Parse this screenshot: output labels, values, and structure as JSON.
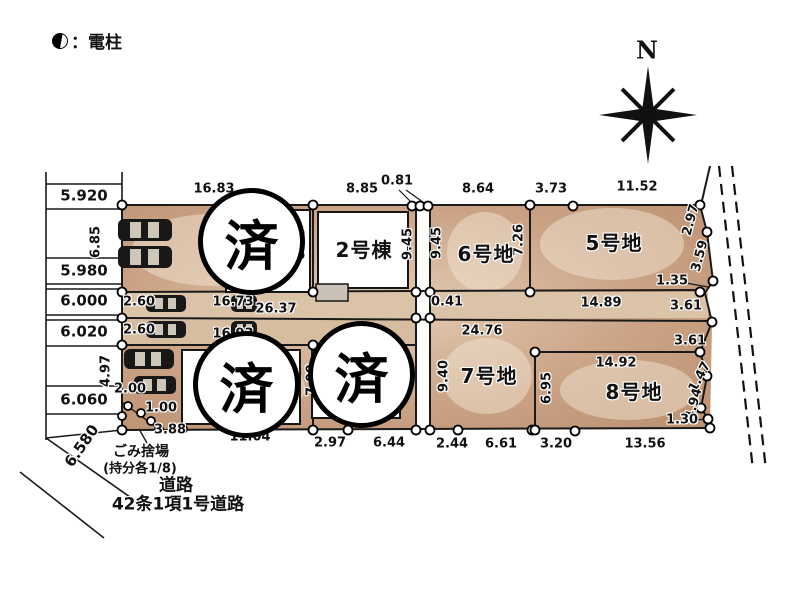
{
  "legend": {
    "label": "：電柱"
  },
  "compass": {
    "label": "N"
  },
  "sold_mark": "済",
  "colors": {
    "lot_fill": "#cba285",
    "lot_highlight": "#f1e5d3",
    "driveway": "#dbc3a8",
    "line": "#1a1a1a",
    "marker_fill": "#ffffff",
    "sold_border": "#000000"
  },
  "labels": [
    {
      "t": "16.83",
      "x": 214,
      "y": 189
    },
    {
      "t": "8.85",
      "x": 362,
      "y": 189
    },
    {
      "t": "0.81",
      "x": 397,
      "y": 181
    },
    {
      "t": "8.64",
      "x": 478,
      "y": 189
    },
    {
      "t": "3.73",
      "x": 551,
      "y": 189
    },
    {
      "t": "11.52",
      "x": 637,
      "y": 187
    },
    {
      "t": "6.85",
      "x": 96,
      "y": 242,
      "r": -90
    },
    {
      "t": "6.85",
      "x": 301,
      "y": 244,
      "r": -90
    },
    {
      "t": "9.45",
      "x": 408,
      "y": 244,
      "r": -90
    },
    {
      "t": "9.45",
      "x": 437,
      "y": 243,
      "r": -90
    },
    {
      "t": "7.26",
      "x": 519,
      "y": 240,
      "r": -90
    },
    {
      "t": "2.97",
      "x": 691,
      "y": 220,
      "r": -75
    },
    {
      "t": "3.59",
      "x": 700,
      "y": 256,
      "r": -75
    },
    {
      "t": "1.35",
      "x": 672,
      "y": 281
    },
    {
      "t": "0.41",
      "x": 447,
      "y": 302
    },
    {
      "t": "14.89",
      "x": 601,
      "y": 303
    },
    {
      "t": "3.61",
      "x": 686,
      "y": 306
    },
    {
      "t": "2.60",
      "x": 139,
      "y": 302
    },
    {
      "t": "16.73",
      "x": 233,
      "y": 302
    },
    {
      "t": "26.37",
      "x": 276,
      "y": 309
    },
    {
      "t": "2.60",
      "x": 139,
      "y": 330
    },
    {
      "t": "16.93",
      "x": 233,
      "y": 334
    },
    {
      "t": "24.76",
      "x": 482,
      "y": 331
    },
    {
      "t": "3.61",
      "x": 690,
      "y": 341
    },
    {
      "t": "4.97",
      "x": 106,
      "y": 371,
      "r": -90
    },
    {
      "t": "2.00",
      "x": 130,
      "y": 389
    },
    {
      "t": "1.00",
      "x": 161,
      "y": 408
    },
    {
      "t": "3.88",
      "x": 170,
      "y": 430
    },
    {
      "t": "11.04",
      "x": 250,
      "y": 437
    },
    {
      "t": "7.09",
      "x": 312,
      "y": 380,
      "r": -90
    },
    {
      "t": "9.40",
      "x": 444,
      "y": 376,
      "r": -90
    },
    {
      "t": "6.95",
      "x": 547,
      "y": 388,
      "r": -90
    },
    {
      "t": "14.92",
      "x": 616,
      "y": 363
    },
    {
      "t": "1.47",
      "x": 700,
      "y": 377,
      "r": -62
    },
    {
      "t": "4.94",
      "x": 694,
      "y": 404,
      "r": -75
    },
    {
      "t": "1.30",
      "x": 682,
      "y": 420
    },
    {
      "t": "2.97",
      "x": 330,
      "y": 443
    },
    {
      "t": "6.44",
      "x": 389,
      "y": 443
    },
    {
      "t": "2.44",
      "x": 452,
      "y": 444
    },
    {
      "t": "6.61",
      "x": 501,
      "y": 444
    },
    {
      "t": "3.20",
      "x": 556,
      "y": 444
    },
    {
      "t": "13.56",
      "x": 645,
      "y": 444
    },
    {
      "t": "6.580",
      "x": 82,
      "y": 446,
      "r": -55,
      "cls": "col-num"
    },
    {
      "t": "5.920",
      "x": 84,
      "y": 196,
      "cls": "col-num"
    },
    {
      "t": "5.980",
      "x": 84,
      "y": 271,
      "cls": "col-num"
    },
    {
      "t": "6.000",
      "x": 84,
      "y": 301,
      "cls": "col-num"
    },
    {
      "t": "6.020",
      "x": 84,
      "y": 332,
      "cls": "col-num"
    },
    {
      "t": "6.060",
      "x": 84,
      "y": 400,
      "cls": "col-num"
    },
    {
      "t": "2号棟",
      "x": 364,
      "y": 250,
      "cls": "lot-name",
      "n": "building-2-label"
    },
    {
      "t": "6号地",
      "x": 486,
      "y": 254,
      "cls": "lot-name",
      "n": "lot-6-label"
    },
    {
      "t": "5号地",
      "x": 614,
      "y": 243,
      "cls": "lot-name",
      "n": "lot-5-label"
    },
    {
      "t": "7号地",
      "x": 489,
      "y": 376,
      "cls": "lot-name",
      "n": "lot-7-label"
    },
    {
      "t": "8号地",
      "x": 634,
      "y": 392,
      "cls": "lot-name",
      "n": "lot-8-label"
    },
    {
      "t": "ごみ捨場",
      "x": 141,
      "y": 452,
      "cls": "note",
      "n": "garbage-area-label"
    },
    {
      "t": "(持分各1/8)",
      "x": 140,
      "y": 469,
      "cls": "note small",
      "n": "garbage-share-label"
    },
    {
      "t": "道路",
      "x": 176,
      "y": 486,
      "cls": "note big",
      "n": "road-label"
    },
    {
      "t": "42条1項1号道路",
      "x": 178,
      "y": 505,
      "cls": "note big",
      "n": "road-type-label"
    }
  ]
}
